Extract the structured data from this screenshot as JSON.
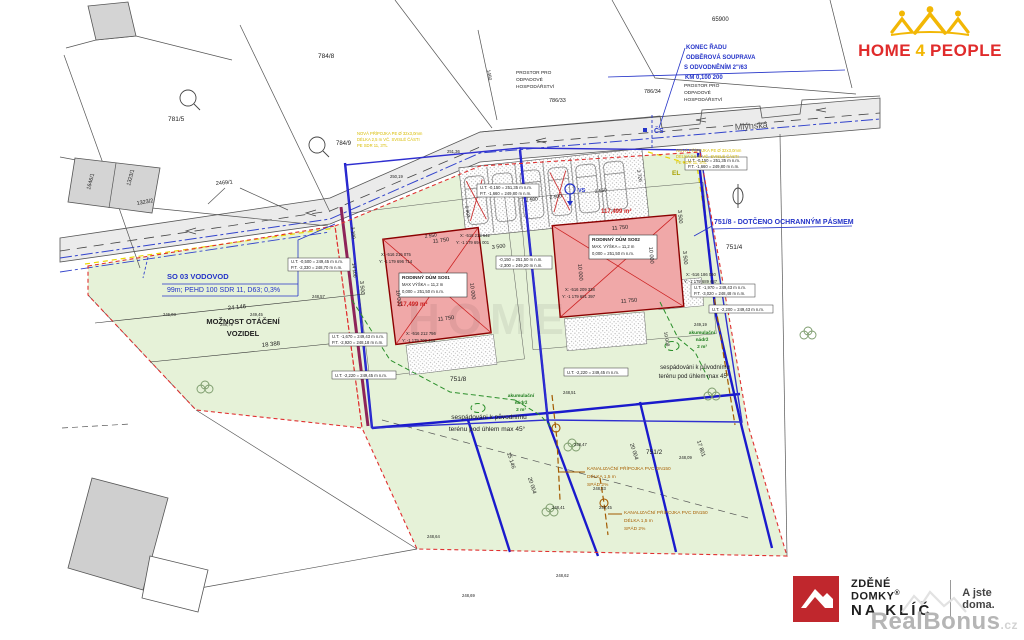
{
  "logos": {
    "home4people": {
      "word1": "HOME",
      "word2": "4",
      "word3": "PEOPLE"
    },
    "zdene_domky": {
      "brand1": "ZDĚNÉ",
      "brand2": "DOMKY",
      "reg": "®",
      "brand3": "NA KLÍČ",
      "tagline": "A jste doma."
    },
    "realbonus": {
      "name": "RealBonus",
      "tld": ".cz"
    }
  },
  "plan": {
    "watermark": "HOME",
    "street": "Mlýnská",
    "cs": "ČS",
    "vs": "VS",
    "el": "EL",
    "konec": [
      "KONEC ŘADU",
      "ODBĚROVÁ SOUPRAVA",
      "S ODVODNĚNÍM 2\"/63",
      "KM 0,100 200"
    ],
    "dotceno": "751/8 - DOTČENO OCHRANNÝM PÁSMEM",
    "vodovod": [
      "SO 03 VODOVOD",
      "99m; PEHD 100 SDR 11, D63; 0,3%"
    ],
    "moznost": [
      "MOŽNOST OTÁČENÍ",
      "VOZIDEL"
    ],
    "sespad": [
      "sespádováni k původnímu",
      "terénu pod úhlem max 45°"
    ],
    "akum": [
      "akumulační",
      "nádrž",
      "2 m³"
    ],
    "kanal": [
      "KANALIZAČNÍ PŘÍPOJKA PVC DN150",
      "DÉLKA 1,5 m",
      "SPÁD 2%"
    ],
    "nova": [
      "NOVÁ PŘÍPOJKA PE Ø 32x3,0mm",
      "DÉLKA 2,5 m VČ. SVISLÉ ČÁSTI",
      "PE SDR 11, 3TL"
    ],
    "prostor": [
      "PROSTOR PRO",
      "ODPADOVÉ",
      "HOSPODÁŘSTVÍ"
    ],
    "so01": [
      "RODINNÝ DŮM SO01",
      "MAX VÝŠKA = 11,2 m",
      "0,000 = 251,50 m n.m."
    ],
    "so02": [
      "RODINNÝ DŮM SO02",
      "MAX. VÝŠKA = 11,2 m",
      "0,000 = 251,50 m n.m."
    ],
    "area_so01": "117,499 m²",
    "area_so02": "117,499 m²",
    "parcels": {
      "p65900": "65900",
      "p784_8": "784/8",
      "p784_9": "784/9",
      "p781_5": "781/5",
      "p786_33": "786/33",
      "p786_34": "786/34",
      "p751_2": "751/2",
      "p751_4": "751/4",
      "p751_8": "751/8",
      "p1646_1": "1646/1",
      "p1323_1": "1323/1",
      "p1323_2": "1323/2",
      "p2469_1": "2469/1",
      "p1460": "1460"
    },
    "coords": [
      {
        "x": "X: -516 215 075",
        "y": "Y: -1 179 696 714"
      },
      {
        "x": "X: -516 213 642",
        "y": "Y: -1 179 694 001"
      },
      {
        "x": "X: -516 212 756",
        "y": "Y: -1 179 700 444"
      },
      {
        "x": "X: -516 209 338",
        "y": "Y: -1 179 691 397"
      },
      {
        "x": "X: -516 186 060",
        "y": "Y: -1 179 689 687"
      }
    ],
    "elev": [
      [
        "U.T. -0,500 = 249,45 m n.m.",
        "P.T. -2,330 = 248,70 m n.m."
      ],
      [
        "U.T. -0,150 = 251,35 m n.m.",
        "P.T. -1,660 = 249,80 m n.m."
      ],
      [
        "U.T. -0,150 = 251,35 m n.m.",
        "P.T. -1,660 = 249,80 m n.m."
      ],
      [
        "-0,150 = 251,50 m n.m.",
        "-2,300 = 249,20 m n.m."
      ],
      [
        "U.T. -2,220 = 249,45 m n.m."
      ],
      [
        "U.T. -1,970 = 249,43 m n.m.",
        "P.T. -3,020 = 248,48 m n.m."
      ],
      [
        "U.T. -2,200 = 249,43 m n.m."
      ],
      [
        "U.T. -1,670 = 249,43 m n.m.",
        "P.T. -2,920 = 248,18 m n.m."
      ],
      [
        "U.T. -2,220 = 249,45 m n.m."
      ]
    ],
    "dims": [
      "24 146",
      "18 388",
      "11 750",
      "11 750",
      "10 000",
      "10 000",
      "3 500",
      "3 500",
      "11 750",
      "11 750",
      "10 000",
      "10 000",
      "3 500",
      "3 500",
      "2 500",
      "2 500",
      "2 550",
      "2 550",
      "14 100",
      "3 100",
      "15 146",
      "20 004",
      "20 004",
      "17 801",
      "10 008",
      "5 903",
      "3 720"
    ],
    "spots": [
      "249,45",
      "248,57",
      "246,03",
      "248,79",
      "250,19",
      "251,36",
      "248,51",
      "248,47",
      "248,33",
      "248,09",
      "248,45",
      "248,64",
      "248,62",
      "248,69",
      "248,41",
      "249,19"
    ]
  }
}
